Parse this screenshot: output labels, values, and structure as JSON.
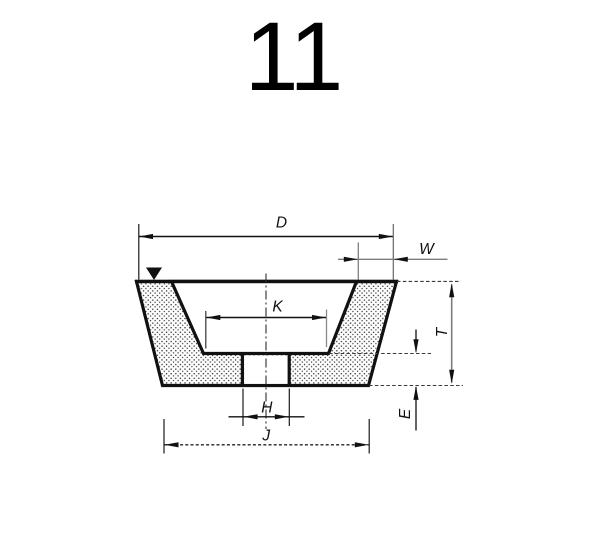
{
  "page": {
    "background": "#ffffff",
    "figure_number": "11"
  },
  "diagram": {
    "type": "technical-drawing",
    "subject": "flaring-cup grinding wheel cross-section, type 11",
    "dimension_labels": {
      "d": "D",
      "w": "W",
      "k": "K",
      "t": "T",
      "h": "H",
      "e": "E",
      "j": "J"
    },
    "colors": {
      "ink": "#111111",
      "gray_line": "#7d7d7d",
      "stipple_dot": "#333333",
      "background": "#ffffff"
    }
  }
}
